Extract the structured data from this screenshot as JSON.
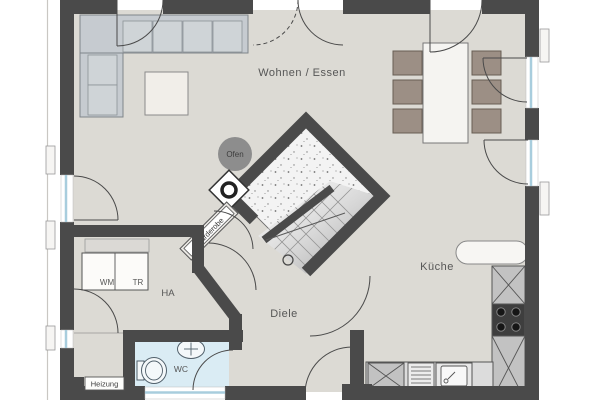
{
  "plan": {
    "labels": {
      "living_dining": "Wohnen / Essen",
      "kitchen": "Küche",
      "hallway": "Diele",
      "house_connection": "HA",
      "wc": "WC",
      "heating": "Heizung",
      "wardrobe": "Garderobe",
      "oven": "Ofen",
      "washing_machine": "WM",
      "dryer": "TR"
    },
    "colors": {
      "wall": "#4a4a4a",
      "floor": "#dcdad4",
      "wc_floor": "#daecf4",
      "glass": "#a8cddd",
      "chair": "#9c8f85",
      "sofa": "#c9ced2",
      "counter": "#d6d6d6",
      "stove": "#3e3e3e",
      "oven_circle": "#8d8d8d",
      "label_text": "#565656"
    }
  }
}
